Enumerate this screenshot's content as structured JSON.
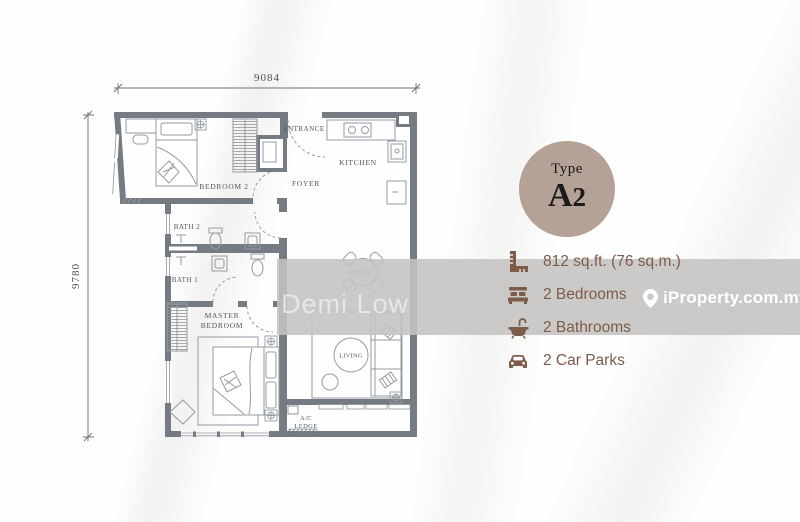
{
  "floor_plan": {
    "dimension_top": "9084",
    "dimension_left": "9780",
    "rooms": {
      "bedroom2": "BEDROOM 2",
      "entrance": "ENTRANCE",
      "kitchen": "KITCHEN",
      "foyer": "FOYER",
      "bath2": "BATH 2",
      "bath1": "BATH 1",
      "master_line1": "MASTER",
      "master_line2": "BEDROOM",
      "dining": "DINING",
      "living": "LIVING",
      "ac_ledge_line1": "A/C",
      "ac_ledge_line2": "LEDGE"
    }
  },
  "badge": {
    "label": "Type",
    "unit_letter": "A",
    "unit_number": "2",
    "bg_color": "#b3a295"
  },
  "details": {
    "items": [
      {
        "icon": "ruler-icon",
        "label": "812 sq.ft. (76 sq.m.)"
      },
      {
        "icon": "bed-icon",
        "label": "2 Bedrooms"
      },
      {
        "icon": "bath-icon",
        "label": "2 Bathrooms"
      },
      {
        "icon": "car-icon",
        "label": "2 Car Parks"
      }
    ],
    "text_color": "#7d5c49"
  },
  "watermarks": {
    "brand": "iProperty.com.my",
    "agent": "Demi Low"
  },
  "colors": {
    "wall": "#747b82",
    "furniture_line": "#949ba2",
    "band": "rgba(197,195,193,0.88)"
  }
}
